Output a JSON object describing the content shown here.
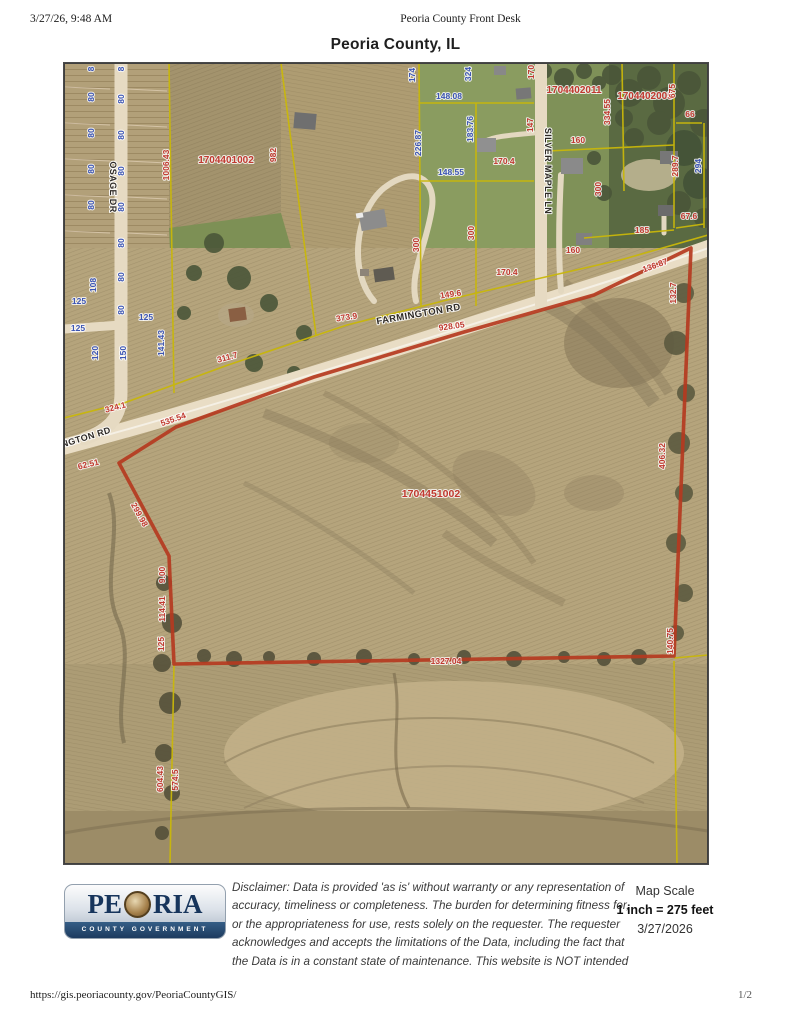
{
  "page": {
    "header_left": "3/27/26, 9:48 AM",
    "header_center": "Peoria County Front Desk",
    "title": "Peoria County, IL",
    "footer_url": "https://gis.peoriacounty.gov/PeoriaCountyGIS/",
    "footer_page": "1/2"
  },
  "footer": {
    "logo_left": "PE",
    "logo_right": "RIA",
    "logo_sub": "COUNTY GOVERNMENT",
    "disclaimer_lines": [
      "Disclaimer: Data is provided 'as is' without warranty or any representation of",
      "accuracy, timeliness or completeness. The burden for determining fitness for,",
      "or the appropriateness for use, rests solely on the requester. The requester",
      "acknowledges and accepts the limitations of the Data, including the fact that",
      "the Data is in a constant state of maintenance. This website is NOT intended"
    ],
    "scale_label": "Map Scale",
    "scale_value": "1 inch = 275 feet",
    "scale_date": "3/27/2026"
  },
  "map": {
    "colors": {
      "dim_red": "#c0392f",
      "dim_blue": "#3c55b4",
      "road_label": "#2e2a26",
      "parcel_line": "#c9b70a",
      "highlight": "#b5391f"
    },
    "parcel_ids": [
      "1704401002",
      "1704402011",
      "1704402005",
      "1704451002"
    ],
    "roads": [
      "OSAGE DR",
      "FARMINGTON RD",
      "SILVER MAPLE LN"
    ],
    "highlight_boundary": [
      [
        55,
        400
      ],
      [
        112,
        364
      ],
      [
        250,
        314
      ],
      [
        400,
        269
      ],
      [
        530,
        232
      ],
      [
        627,
        185
      ],
      [
        610,
        593
      ],
      [
        110,
        601
      ],
      [
        105,
        493
      ]
    ],
    "parcel_lines": [
      [
        [
          105,
          0
        ],
        [
          110,
          330
        ]
      ],
      [
        [
          217,
          0
        ],
        [
          252,
          272
        ]
      ],
      [
        [
          355,
          0
        ],
        [
          357,
          243
        ]
      ],
      [
        [
          355,
          40
        ],
        [
          470,
          40
        ]
      ],
      [
        [
          355,
          118
        ],
        [
          470,
          118
        ]
      ],
      [
        [
          0,
          355
        ],
        [
          60,
          340
        ],
        [
          164,
          302
        ],
        [
          283,
          262
        ],
        [
          387,
          236
        ],
        [
          477,
          215
        ],
        [
          560,
          196
        ],
        [
          644,
          172
        ]
      ],
      [
        [
          412,
          40
        ],
        [
          412,
          243
        ]
      ],
      [
        [
          484,
          88
        ],
        [
          610,
          82
        ]
      ],
      [
        [
          558,
          0
        ],
        [
          560,
          128
        ]
      ],
      [
        [
          610,
          0
        ],
        [
          610,
          165
        ]
      ],
      [
        [
          612,
          60
        ],
        [
          638,
          60
        ]
      ],
      [
        [
          640,
          60
        ],
        [
          640,
          165
        ]
      ],
      [
        [
          520,
          175
        ],
        [
          610,
          167
        ]
      ],
      [
        [
          612,
          165
        ],
        [
          640,
          161
        ]
      ],
      [
        [
          110,
          601
        ],
        [
          106,
          801
        ]
      ],
      [
        [
          610,
          598
        ],
        [
          613,
          801
        ]
      ],
      [
        [
          610,
          595
        ],
        [
          644,
          592
        ]
      ]
    ],
    "labels": [
      {
        "t": "8",
        "x": 30,
        "y": 6,
        "r": -90,
        "c": "blue"
      },
      {
        "t": "8",
        "x": 60,
        "y": 6,
        "r": -90,
        "c": "blue"
      },
      {
        "t": "80",
        "x": 30,
        "y": 34,
        "r": -90,
        "c": "blue"
      },
      {
        "t": "80",
        "x": 30,
        "y": 70,
        "r": -90,
        "c": "blue"
      },
      {
        "t": "80",
        "x": 30,
        "y": 106,
        "r": -90,
        "c": "blue"
      },
      {
        "t": "80",
        "x": 30,
        "y": 142,
        "r": -90,
        "c": "blue"
      },
      {
        "t": "108",
        "x": 32,
        "y": 222,
        "r": -90,
        "c": "blue"
      },
      {
        "t": "120",
        "x": 34,
        "y": 290,
        "r": -90,
        "c": "blue"
      },
      {
        "t": "80",
        "x": 60,
        "y": 36,
        "r": -90,
        "c": "blue"
      },
      {
        "t": "80",
        "x": 60,
        "y": 72,
        "r": -90,
        "c": "blue"
      },
      {
        "t": "80",
        "x": 60,
        "y": 108,
        "r": -90,
        "c": "blue"
      },
      {
        "t": "80",
        "x": 60,
        "y": 144,
        "r": -90,
        "c": "blue"
      },
      {
        "t": "80",
        "x": 60,
        "y": 180,
        "r": -90,
        "c": "blue"
      },
      {
        "t": "80",
        "x": 60,
        "y": 214,
        "r": -90,
        "c": "blue"
      },
      {
        "t": "80",
        "x": 60,
        "y": 247,
        "r": -90,
        "c": "blue"
      },
      {
        "t": "150",
        "x": 62,
        "y": 290,
        "r": -90,
        "c": "blue"
      },
      {
        "t": "125",
        "x": 15,
        "y": 241,
        "c": "blue"
      },
      {
        "t": "125",
        "x": 14,
        "y": 268,
        "c": "blue"
      },
      {
        "t": "125",
        "x": 82,
        "y": 257,
        "c": "blue"
      },
      {
        "t": "141.43",
        "x": 100,
        "y": 280,
        "r": -90,
        "c": "blue"
      },
      {
        "t": "174",
        "x": 351,
        "y": 12,
        "r": -90,
        "c": "blue"
      },
      {
        "t": "324",
        "x": 407,
        "y": 11,
        "r": -90,
        "c": "blue"
      },
      {
        "t": "148.08",
        "x": 385,
        "y": 36,
        "c": "blue"
      },
      {
        "t": "226.87",
        "x": 357,
        "y": 80,
        "r": -90,
        "c": "blue"
      },
      {
        "t": "183.76",
        "x": 409,
        "y": 66,
        "r": -90,
        "c": "blue"
      },
      {
        "t": "148.55",
        "x": 387,
        "y": 112,
        "c": "blue"
      },
      {
        "t": "294",
        "x": 637,
        "y": 103,
        "r": -90,
        "c": "blue"
      },
      {
        "t": "1006.43",
        "x": 105,
        "y": 102,
        "r": -90,
        "c": "red"
      },
      {
        "t": "982",
        "x": 212,
        "y": 92,
        "r": -90,
        "c": "red"
      },
      {
        "t": "1704401002",
        "x": 162,
        "y": 100,
        "s": 10,
        "c": "red"
      },
      {
        "t": "170",
        "x": 470,
        "y": 9,
        "r": -90,
        "c": "red"
      },
      {
        "t": "147",
        "x": 469,
        "y": 62,
        "r": -90,
        "c": "red"
      },
      {
        "t": "1704402011",
        "x": 510,
        "y": 30,
        "s": 10,
        "c": "red"
      },
      {
        "t": "334.55",
        "x": 546,
        "y": 49,
        "r": -90,
        "c": "red"
      },
      {
        "t": "1704402005",
        "x": 581,
        "y": 36,
        "s": 10,
        "c": "red"
      },
      {
        "t": "675",
        "x": 611,
        "y": 28,
        "r": -90,
        "c": "red"
      },
      {
        "t": "66",
        "x": 626,
        "y": 54,
        "c": "red"
      },
      {
        "t": "289.7",
        "x": 614,
        "y": 103,
        "r": -90,
        "c": "red"
      },
      {
        "t": "160",
        "x": 514,
        "y": 80,
        "c": "red"
      },
      {
        "t": "300",
        "x": 537,
        "y": 126,
        "r": -90,
        "c": "red"
      },
      {
        "t": "67.6",
        "x": 625,
        "y": 156,
        "c": "red"
      },
      {
        "t": "185",
        "x": 578,
        "y": 170,
        "c": "red"
      },
      {
        "t": "136.87",
        "x": 592,
        "y": 205,
        "r": -20,
        "c": "red"
      },
      {
        "t": "132.7",
        "x": 612,
        "y": 230,
        "r": -90,
        "c": "red"
      },
      {
        "t": "170.4",
        "x": 440,
        "y": 101,
        "c": "red"
      },
      {
        "t": "300",
        "x": 355,
        "y": 182,
        "r": -90,
        "c": "red"
      },
      {
        "t": "300",
        "x": 410,
        "y": 170,
        "r": -90,
        "c": "red"
      },
      {
        "t": "170.4",
        "x": 443,
        "y": 212,
        "c": "red"
      },
      {
        "t": "160",
        "x": 509,
        "y": 190,
        "c": "red"
      },
      {
        "t": "149.6",
        "x": 387,
        "y": 234,
        "r": -8,
        "c": "red"
      },
      {
        "t": "928.05",
        "x": 388,
        "y": 266,
        "r": -8,
        "c": "red"
      },
      {
        "t": "373.9",
        "x": 283,
        "y": 257,
        "r": -9,
        "c": "red"
      },
      {
        "t": "311.7",
        "x": 164,
        "y": 297,
        "r": -15,
        "c": "red"
      },
      {
        "t": "324.1",
        "x": 52,
        "y": 347,
        "r": -15,
        "c": "red"
      },
      {
        "t": "535.54",
        "x": 110,
        "y": 359,
        "r": -19,
        "c": "red"
      },
      {
        "t": "62.51",
        "x": 25,
        "y": 404,
        "r": -14,
        "c": "red"
      },
      {
        "t": "299.98",
        "x": 73,
        "y": 453,
        "r": 61,
        "c": "red"
      },
      {
        "t": "9.00",
        "x": 101,
        "y": 512,
        "r": -90,
        "c": "red"
      },
      {
        "t": "114.41",
        "x": 101,
        "y": 546,
        "r": -90,
        "c": "red"
      },
      {
        "t": "125",
        "x": 100,
        "y": 581,
        "r": -90,
        "c": "red"
      },
      {
        "t": "1704451002",
        "x": 367,
        "y": 434,
        "s": 10.5,
        "c": "red"
      },
      {
        "t": "1327.04",
        "x": 382,
        "y": 601,
        "c": "red"
      },
      {
        "t": "140.75",
        "x": 609,
        "y": 578,
        "r": -90,
        "c": "red"
      },
      {
        "t": "406.32",
        "x": 601,
        "y": 393,
        "r": -90,
        "c": "red"
      },
      {
        "t": "604.43",
        "x": 99,
        "y": 716,
        "r": -90,
        "c": "red"
      },
      {
        "t": "574.5",
        "x": 114,
        "y": 717,
        "r": -90,
        "c": "red"
      },
      {
        "t": "OSAGE DR",
        "x": 46,
        "y": 124,
        "r": 90,
        "s": 9,
        "c": "road"
      },
      {
        "t": "SILVER MAPLE LN",
        "x": 481,
        "y": 108,
        "r": 90,
        "s": 9,
        "c": "road"
      },
      {
        "t": "FARMINGTON RD",
        "x": 355,
        "y": 254,
        "r": -10,
        "s": 9.5,
        "c": "road"
      },
      {
        "t": "NGTON RD",
        "x": 23,
        "y": 377,
        "r": -17,
        "s": 9,
        "c": "road"
      }
    ]
  }
}
